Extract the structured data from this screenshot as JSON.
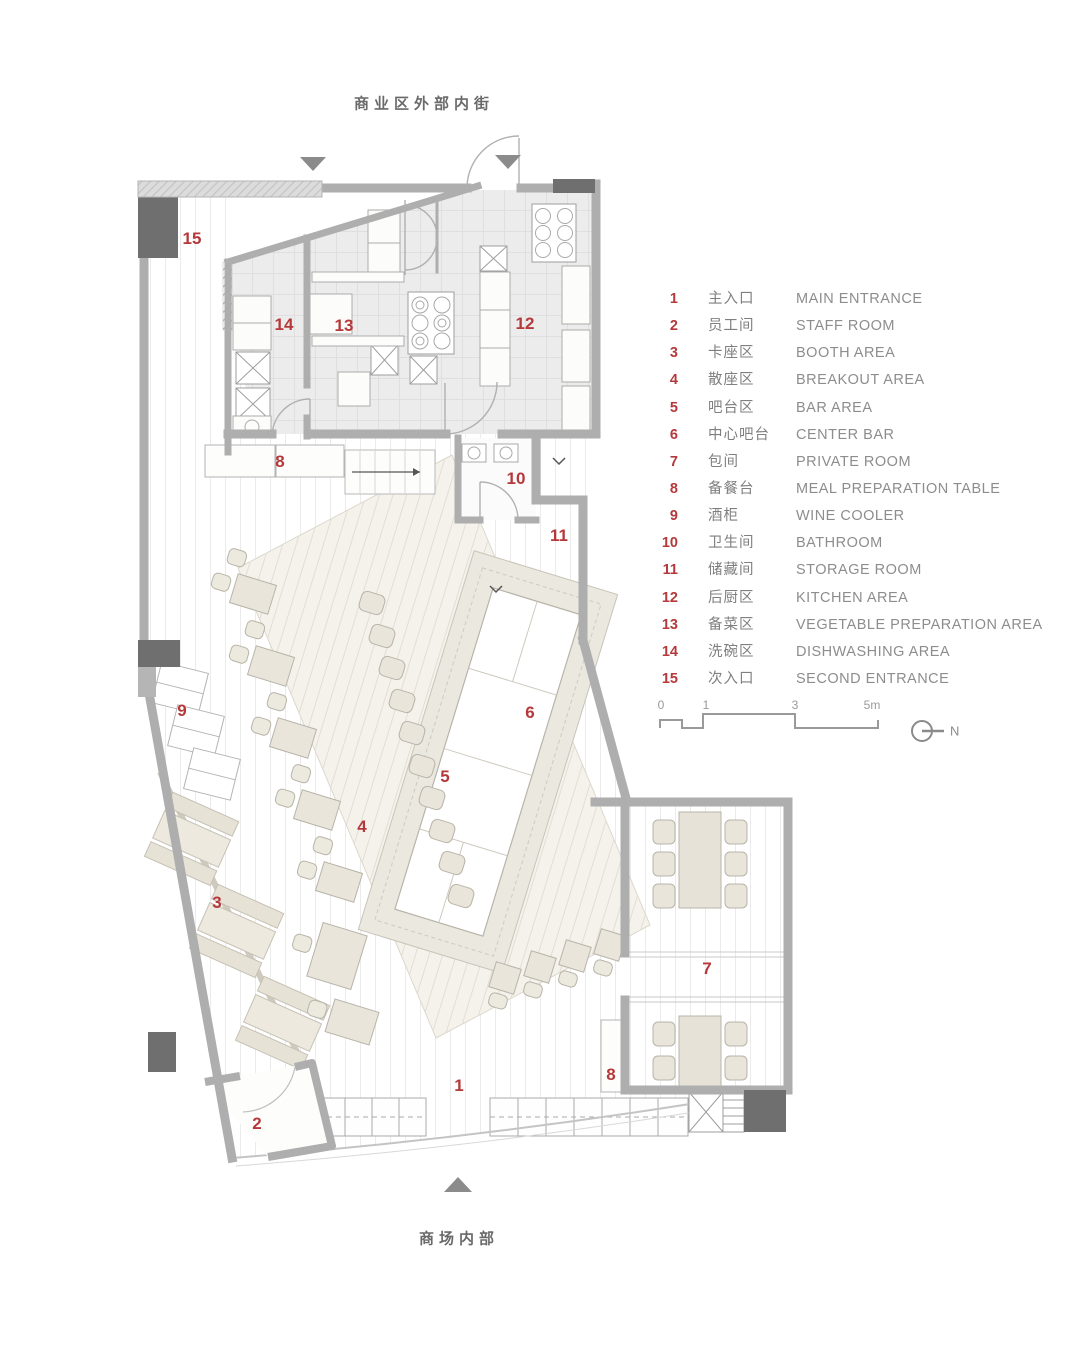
{
  "page": {
    "top_street_label": "商业区外部内街",
    "bottom_mall_label": "商场内部"
  },
  "legend": {
    "items": [
      {
        "num": "1",
        "zh": "主入口",
        "en": "MAIN ENTRANCE"
      },
      {
        "num": "2",
        "zh": "员工间",
        "en": "STAFF ROOM"
      },
      {
        "num": "3",
        "zh": "卡座区",
        "en": "BOOTH AREA"
      },
      {
        "num": "4",
        "zh": "散座区",
        "en": "BREAKOUT AREA"
      },
      {
        "num": "5",
        "zh": "吧台区",
        "en": "BAR AREA"
      },
      {
        "num": "6",
        "zh": "中心吧台",
        "en": "CENTER BAR"
      },
      {
        "num": "7",
        "zh": "包间",
        "en": "PRIVATE ROOM"
      },
      {
        "num": "8",
        "zh": "备餐台",
        "en": "MEAL PREPARATION TABLE"
      },
      {
        "num": "9",
        "zh": "酒柜",
        "en": "WINE COOLER"
      },
      {
        "num": "10",
        "zh": "卫生间",
        "en": "BATHROOM"
      },
      {
        "num": "11",
        "zh": "储藏间",
        "en": "STORAGE ROOM"
      },
      {
        "num": "12",
        "zh": "后厨区",
        "en": "KITCHEN AREA"
      },
      {
        "num": "13",
        "zh": "备菜区",
        "en": "VEGETABLE PREPARATION AREA"
      },
      {
        "num": "14",
        "zh": "洗碗区",
        "en": "DISHWASHING AREA"
      },
      {
        "num": "15",
        "zh": "次入口",
        "en": "SECOND ENTRANCE"
      }
    ]
  },
  "scale_bar": {
    "ticks": [
      "0",
      "1",
      "3",
      "5m"
    ]
  },
  "north_label": "N",
  "plan_labels": {
    "l15": "15",
    "l14": "14",
    "l13": "13",
    "l12": "12",
    "l8a": "8",
    "l10": "10",
    "l11": "11",
    "l9": "9",
    "l6": "6",
    "l5": "5",
    "l4": "4",
    "l3": "3",
    "l7": "7",
    "l8b": "8",
    "l1": "1",
    "l2": "2"
  },
  "colors": {
    "accent_red": "#b5393b",
    "wall_gray": "#aeaeae",
    "column_gray": "#6f6f6f",
    "furniture_beige": "#e9e5db"
  }
}
